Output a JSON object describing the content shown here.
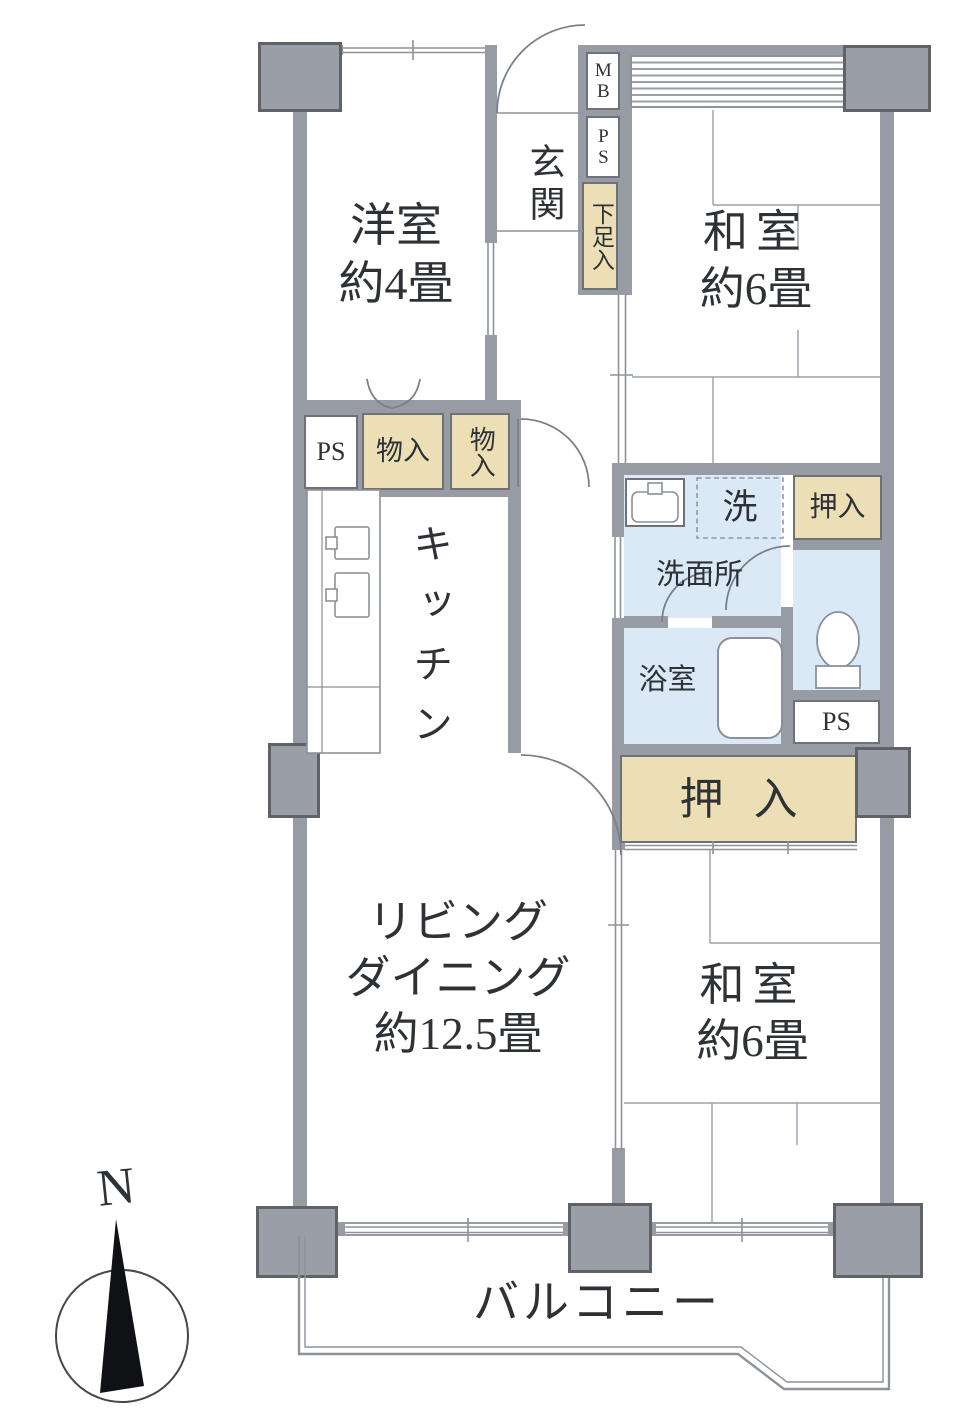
{
  "plan": {
    "compass": {
      "north": "N"
    },
    "balcony": {
      "label": "バルコニー"
    },
    "entrance": {
      "label": "玄関",
      "meter_box": "MB",
      "pipe_space": "PS",
      "shoe_box": "下足入"
    },
    "western_room": {
      "name": "洋室",
      "size": "約4畳"
    },
    "japanese_room_top": {
      "name": "和室",
      "size": "約6畳"
    },
    "japanese_room_bottom": {
      "name": "和室",
      "size": "約6畳"
    },
    "living_dining": {
      "line1": "リビング",
      "line2": "ダイニング",
      "size": "約12.5畳"
    },
    "kitchen": {
      "label": "キッチン",
      "pipe_space": "PS",
      "storage_left": "物入",
      "storage_right": "物入"
    },
    "sanitary": {
      "washer": "洗",
      "washroom": "洗面所",
      "bathroom": "浴室",
      "pipe_space": "PS"
    },
    "closets": {
      "top": "押入",
      "bottom": "押入"
    }
  }
}
